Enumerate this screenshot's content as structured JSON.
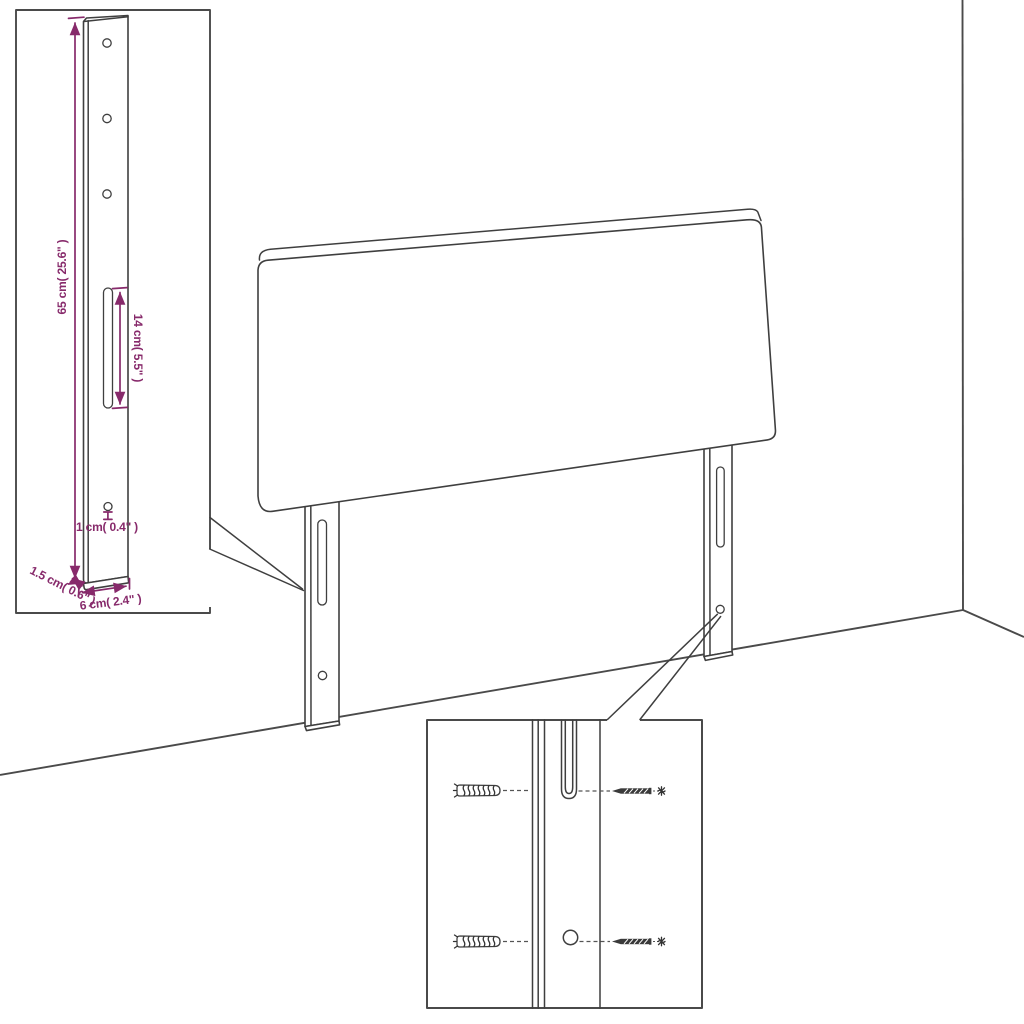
{
  "diagram": {
    "title": "headboard-wall-mount-dimension-diagram",
    "colors": {
      "background": "#ffffff",
      "line": "#3f3f3f",
      "inset_border": "#4a4a4a",
      "accent_dimension": "#872A6B"
    },
    "insets": {
      "leg_detail": {
        "dimensions": {
          "height": "65 cm( 25.6\" )",
          "slot_length": "14 cm( 5.5\" )",
          "hole_diameter": "1 cm( 0.4\" )",
          "thickness": "1.5 cm( 0.6\" )",
          "width": "6 cm( 2.4\" )"
        }
      },
      "hardware_detail": {
        "left_items": [
          "wall-plug-anchor-icon",
          "wall-plug-anchor-icon"
        ],
        "right_items": [
          "screw-icon",
          "screw-icon"
        ]
      }
    }
  }
}
